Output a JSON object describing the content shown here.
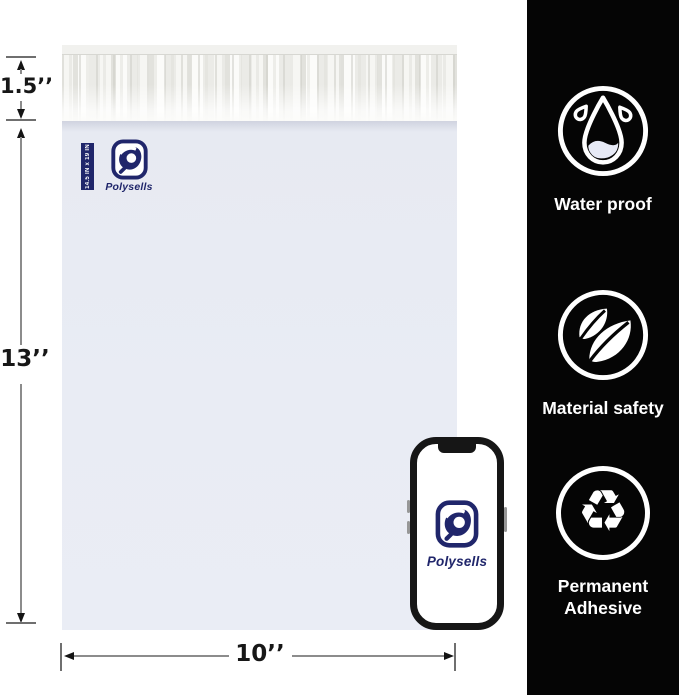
{
  "bag": {
    "brand": "Polysells",
    "size_strip_label": "14.5 IN x 19 IN"
  },
  "phone": {
    "brand": "Polysells"
  },
  "dimensions": {
    "flap_height": "1.5’’",
    "bag_height": "13’’",
    "bag_width": "10’’"
  },
  "features": [
    {
      "icon": "water-drop-icon",
      "label": "Water proof"
    },
    {
      "icon": "leaves-icon",
      "label": "Material safety"
    },
    {
      "icon": "recycle-icon",
      "label": "Permanent Adhesive",
      "glyph": "♻"
    }
  ],
  "colors": {
    "accent_navy": "#20266b",
    "panel_black": "#050505",
    "bag_body": "#e9ecf4",
    "dimension_line": "#8c8c8c"
  }
}
